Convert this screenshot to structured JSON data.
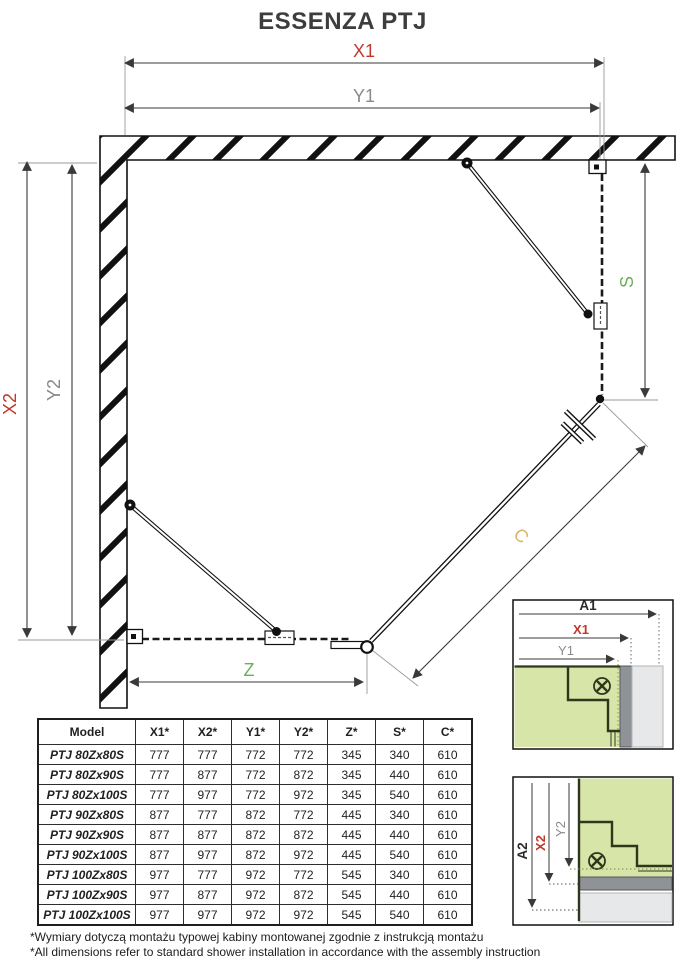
{
  "title": "ESSENZA PTJ",
  "diagram": {
    "labels": {
      "x1": "X1",
      "y1": "Y1",
      "x2": "X2",
      "y2": "Y2",
      "s": "S",
      "z": "Z",
      "c": "C"
    },
    "colors": {
      "dimension_red": "#c0392b",
      "dimension_gray": "#8a8a8a",
      "dimension_green": "#6aaf5a",
      "dimension_gold": "#d4b25e",
      "wall_black": "#111111",
      "profile_green_fill": "#d8e5a8",
      "profile_outline": "#30361b",
      "wall_gap_gray": "#8f9397",
      "wall_light_gray": "#e7e8e9"
    }
  },
  "details": [
    {
      "labels": {
        "a": "A1",
        "x": "X1",
        "y": "Y1"
      }
    },
    {
      "labels": {
        "a": "A2",
        "x": "X2",
        "y": "Y2"
      }
    }
  ],
  "table": {
    "headers": [
      "Model",
      "X1*",
      "X2*",
      "Y1*",
      "Y2*",
      "Z*",
      "S*",
      "C*"
    ],
    "rows": [
      {
        "model": "PTJ 80Zx80S",
        "values": [
          "777",
          "777",
          "772",
          "772",
          "345",
          "340",
          "610"
        ]
      },
      {
        "model": "PTJ 80Zx90S",
        "values": [
          "777",
          "877",
          "772",
          "872",
          "345",
          "440",
          "610"
        ]
      },
      {
        "model": "PTJ 80Zx100S",
        "values": [
          "777",
          "977",
          "772",
          "972",
          "345",
          "540",
          "610"
        ]
      },
      {
        "model": "PTJ 90Zx80S",
        "values": [
          "877",
          "777",
          "872",
          "772",
          "445",
          "340",
          "610"
        ]
      },
      {
        "model": "PTJ 90Zx90S",
        "values": [
          "877",
          "877",
          "872",
          "872",
          "445",
          "440",
          "610"
        ]
      },
      {
        "model": "PTJ 90Zx100S",
        "values": [
          "877",
          "977",
          "872",
          "972",
          "445",
          "540",
          "610"
        ]
      },
      {
        "model": "PTJ 100Zx80S",
        "values": [
          "977",
          "777",
          "972",
          "772",
          "545",
          "340",
          "610"
        ]
      },
      {
        "model": "PTJ 100Zx90S",
        "values": [
          "977",
          "877",
          "972",
          "872",
          "545",
          "440",
          "610"
        ]
      },
      {
        "model": "PTJ 100Zx100S",
        "values": [
          "977",
          "977",
          "972",
          "972",
          "545",
          "540",
          "610"
        ]
      }
    ]
  },
  "footnotes": [
    "*Wymiary dotyczą montażu typowej kabiny montowanej zgodnie z instrukcją montażu",
    "*All dimensions refer to standard shower installation in accordance with the assembly instruction"
  ]
}
